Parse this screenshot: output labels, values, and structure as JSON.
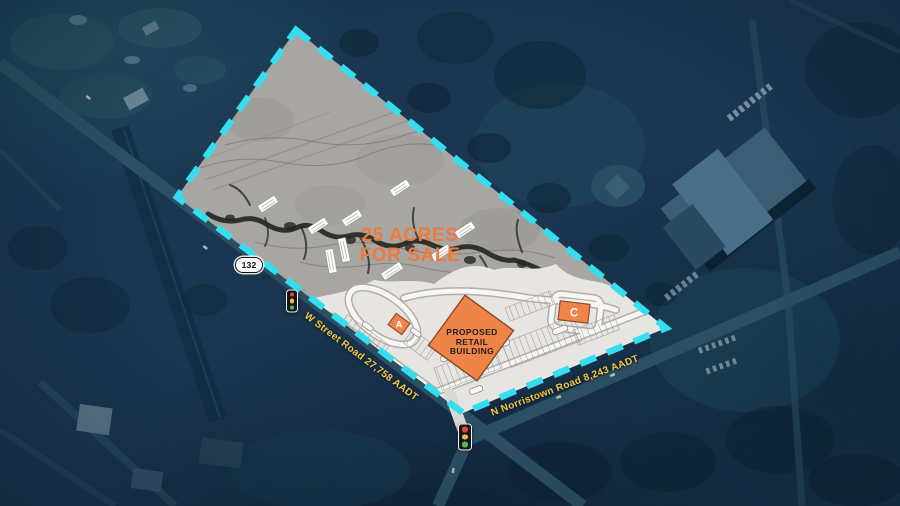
{
  "title": "25 Acres For Sale — aerial site plan",
  "headline": {
    "line1": "25 ACRES",
    "line2": "FOR SALE"
  },
  "site_plan": {
    "proposed_building_label": {
      "line1": "PROPOSED",
      "line2": "RETAIL",
      "line3": "BUILDING"
    },
    "pad_a_label": "A",
    "pad_c_label": "C"
  },
  "roads": {
    "route_shield": "132",
    "w_street_label": "W Street Road 27,758 AADT",
    "n_norristown_label": "N Norristown Road 8,243 AADT"
  },
  "icons": {
    "signal_icon_name": "traffic-light-icon",
    "route_shield_icon_name": "route-shield-icon"
  },
  "colors": {
    "boundary_cyan": "#35DEEE",
    "building_orange": "#EF8449",
    "building_outline": "#8A4A22",
    "headline_orange": "#F0793C",
    "road_label_yellow": "#F5C840",
    "signal_red": "#E8433F",
    "signal_amber": "#F5B83D",
    "signal_green": "#55B95C"
  }
}
